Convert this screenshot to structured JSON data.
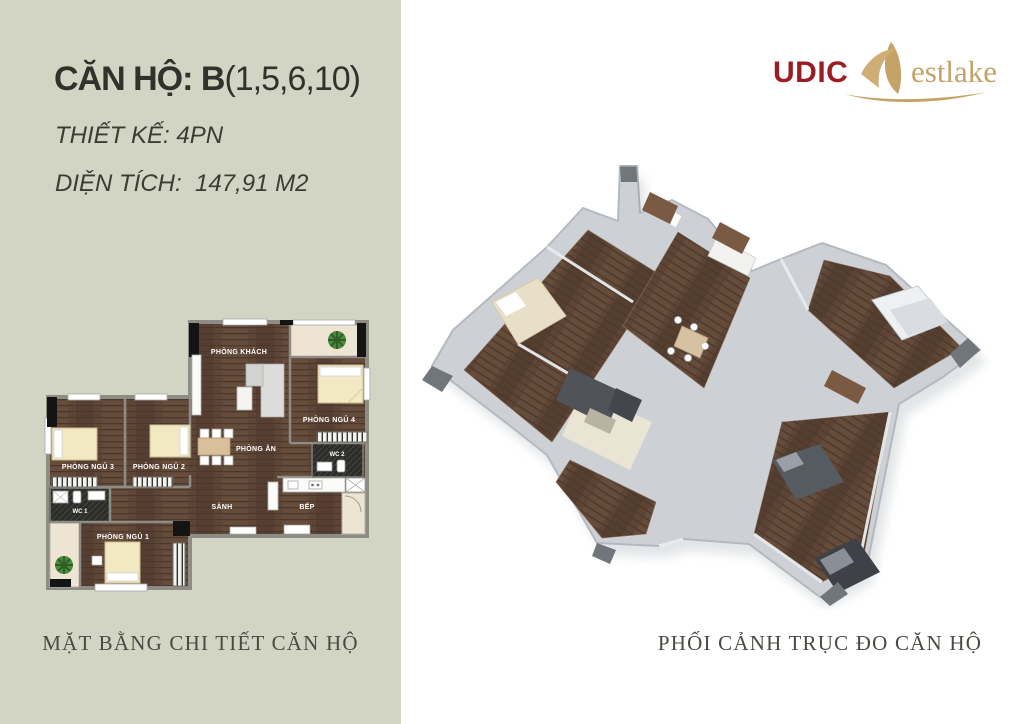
{
  "left_panel": {
    "background_color": "#d2d5c3",
    "title_prefix": "CĂN HỘ: B",
    "title_units": "(1,5,6,10)",
    "design_line": "THIẾT KẾ: 4PN",
    "area_line": "DIỆN TÍCH:  147,91 M2",
    "caption": "MẶT BẰNG CHI TIẾT CĂN HỘ"
  },
  "right_panel": {
    "logo": {
      "brand": "UDIC",
      "suffix": "estlake",
      "brand_color": "#9d1c23",
      "gold_color": "#c5a266"
    },
    "caption": "PHỐI CẢNH TRỤC ĐO CĂN HỘ"
  },
  "floorplan": {
    "rooms": [
      {
        "label": "PHÒNG KHÁCH"
      },
      {
        "label": "PHÒNG NGỦ 4"
      },
      {
        "label": "WC 2"
      },
      {
        "label": "PHÒNG ĂN"
      },
      {
        "label": "PHÒNG NGỦ 2"
      },
      {
        "label": "PHÒNG NGỦ 3"
      },
      {
        "label": "WC 1"
      },
      {
        "label": "SẢNH"
      },
      {
        "label": "BẾP"
      },
      {
        "label": "PHÒNG NGỦ 1"
      }
    ],
    "colors": {
      "wood_floor": "#5e4536",
      "wall": "#8d8d85",
      "bed": "#f2e9c2",
      "balcony": "#eee4d4",
      "wc": "#2c2c2a",
      "plant": "#4a8a3a"
    }
  }
}
